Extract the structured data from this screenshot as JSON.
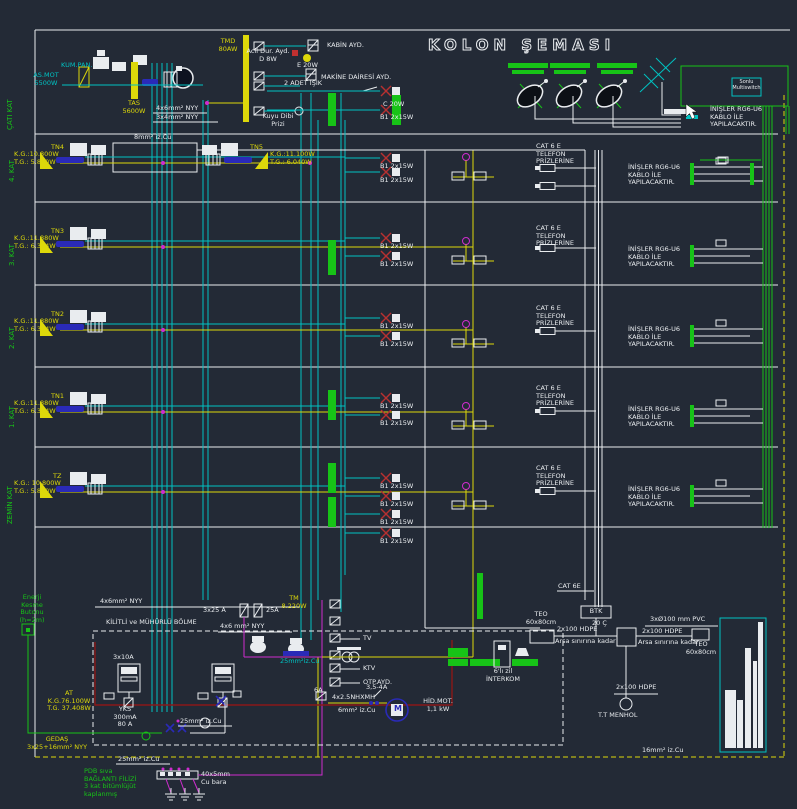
{
  "title": "KOLON ŞEMASI",
  "accent_colors": {
    "background": "#232a36",
    "cyan": "#00c2c2",
    "yellow": "#ddd80a",
    "green": "#17c317",
    "magenta": "#cf2ccf",
    "white": "#e9ecef"
  },
  "floor_strip": [
    "ÇATI KAT",
    "4. KAT",
    "3. KAT",
    "2. KAT",
    "1. KAT",
    "ZEMİN KAT"
  ],
  "roof": {
    "as_mot": "AS.MOT\n5500W",
    "kum_pan": "KUM.PAN.",
    "tas": "TAS\n5600W",
    "tmd": "TMD\n80AW",
    "feed_a": "4x6mm² NYY",
    "feed_b": "3x4mm² NYY",
    "acil": "Acil Dur. Ayd.\nD 8W",
    "e20": "E 20W",
    "kabin": "KABİN AYD.",
    "makine": "MAKİNE DAİRESİ AYD.",
    "iki_adet": "2 ADET IŞIK",
    "kuyu": "Kuyu Dibi\nPrizi",
    "c20": "C 20W",
    "cu8": "8mm² iz.Cu"
  },
  "sat": {
    "multiswitch": "Sonlu\nMultiswitch",
    "inisler": "İNİŞLER RG6-U6\nKABLO İLE\nYAPILACAKTIR."
  },
  "floors": {
    "b1": "B1 2x15W",
    "cat_tel": "CAT 6 E\nTELEFON\nPRİZLERİNE",
    "inisler": "İNİŞLER RG6-U6\nKABLO İLE\nYAPILACAKTIR.",
    "cat6e": "CAT 6E",
    "panels": [
      {
        "name": "TN4",
        "load": "K.G.:10.800W\nT.G.: 5.840W"
      },
      {
        "name": "TN5",
        "load": "K.G.:11.100W\nT.G.: 6.040W"
      },
      {
        "name": "TN3",
        "load": "K.G.:11.880W\nT.G.: 6.344W"
      },
      {
        "name": "TN2",
        "load": "K.G.:11.880W\nT.G.: 6.344W"
      },
      {
        "name": "TN1",
        "load": "K.G.:11.880W\nT.G.: 6.344W"
      },
      {
        "name": "TZ",
        "load": "K.G.: 10.800W\nT.G.: 5.840W"
      }
    ]
  },
  "bottom": {
    "enerji": "Enerji\nKesme\nButonu\n(h=2m)",
    "nyy_a": "4x6mm² NYY",
    "kilitli": "KİLİTLİ ve MÜHÜRLÜ BÖLME",
    "f_3x25": "3x25 A",
    "f_25": "25A",
    "nyy_b": "4x6 mm² NYY",
    "a_3x10": "3x10A",
    "tm": "TM\n8.220W",
    "at": "AT\nK.G.76.100W\nT.G. 37.408W",
    "yks": "YKS\n300mA\n80 A",
    "gedas": "GEDAŞ\n3x25+16mm² NYY",
    "cu25": "25mm² iz.Cu",
    "cu25c": "25mm²iz.Cu",
    "tv": "TV",
    "ktv": "KTV",
    "otp": "OTP.AYD.",
    "a6": "6A",
    "nhxmh": "4x2.5NHXMH",
    "a354": "3,5-4A",
    "hid": "HİD.MOT.\n1,1 kW",
    "m": "M",
    "cu6": "6mm² iz.Cu",
    "interkom": "6'lı zil\nİNTERKOM",
    "btk": "BTK",
    "c20": "20 Ç",
    "teo": "TEO\n60x80cm",
    "hdpe": "2x100 HDPE",
    "arsa": "Arsa sınırına kadar",
    "pvc": "3xØ100 mm PVC",
    "menhol": "T.T MENHOL",
    "pdb": "PDB sıva\nBAĞLANTI FİLİZİ\n3 kat bitümlüjüt\nkaplanmış",
    "bara": "40x5mm\nCu bara",
    "cu16": "16mm² iz.Cu"
  }
}
